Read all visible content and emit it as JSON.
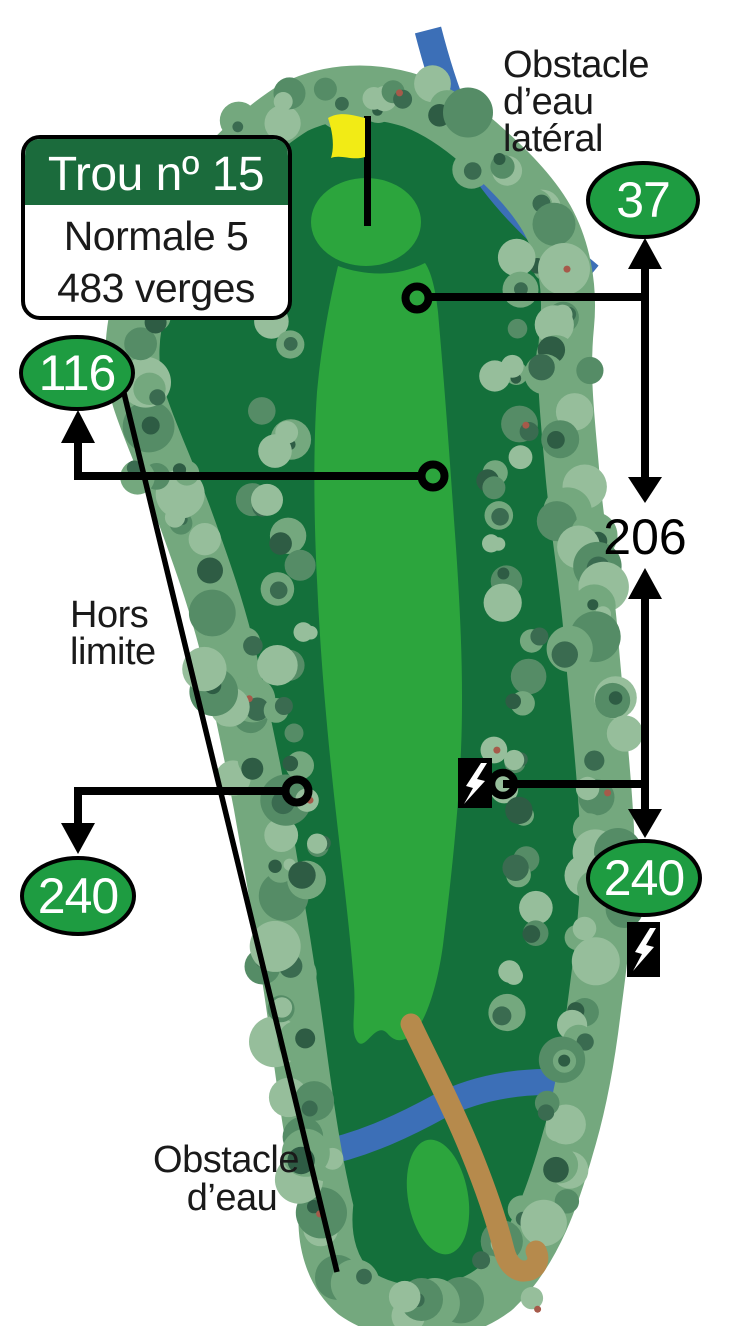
{
  "hole_card": {
    "title": "Trou nº 15",
    "par": "Normale 5",
    "distance": "483 verges"
  },
  "distance_badges": {
    "green_right": "37",
    "upper_left": "116",
    "mid_span": "206",
    "lower_left": "240",
    "lower_right": "240"
  },
  "labels": {
    "lateral_water": [
      "Obstacle",
      "d’eau",
      "latéral"
    ],
    "out_of_bounds": [
      "Hors",
      "limite"
    ],
    "water": [
      "Obstacle",
      "d’eau"
    ]
  },
  "colors": {
    "background": "#FFFFFF",
    "rough_green": "#14703B",
    "fairway_green": "#2CA53D",
    "tree_base": "#74A87E",
    "tree_light": "#96BE9B",
    "tree_mid": "#558C66",
    "tree_dark": "#3A6B50",
    "tree_shadow": "#2E5C44",
    "berry_red": "#A65A4A",
    "water_blue": "#3C6FB7",
    "path_tan": "#B68A4C",
    "badge_green": "#1E9C41",
    "header_green": "#1B6B3C",
    "ink_black": "#000000",
    "flag_yellow": "#F2EB15",
    "text_white": "#FFFFFF"
  }
}
